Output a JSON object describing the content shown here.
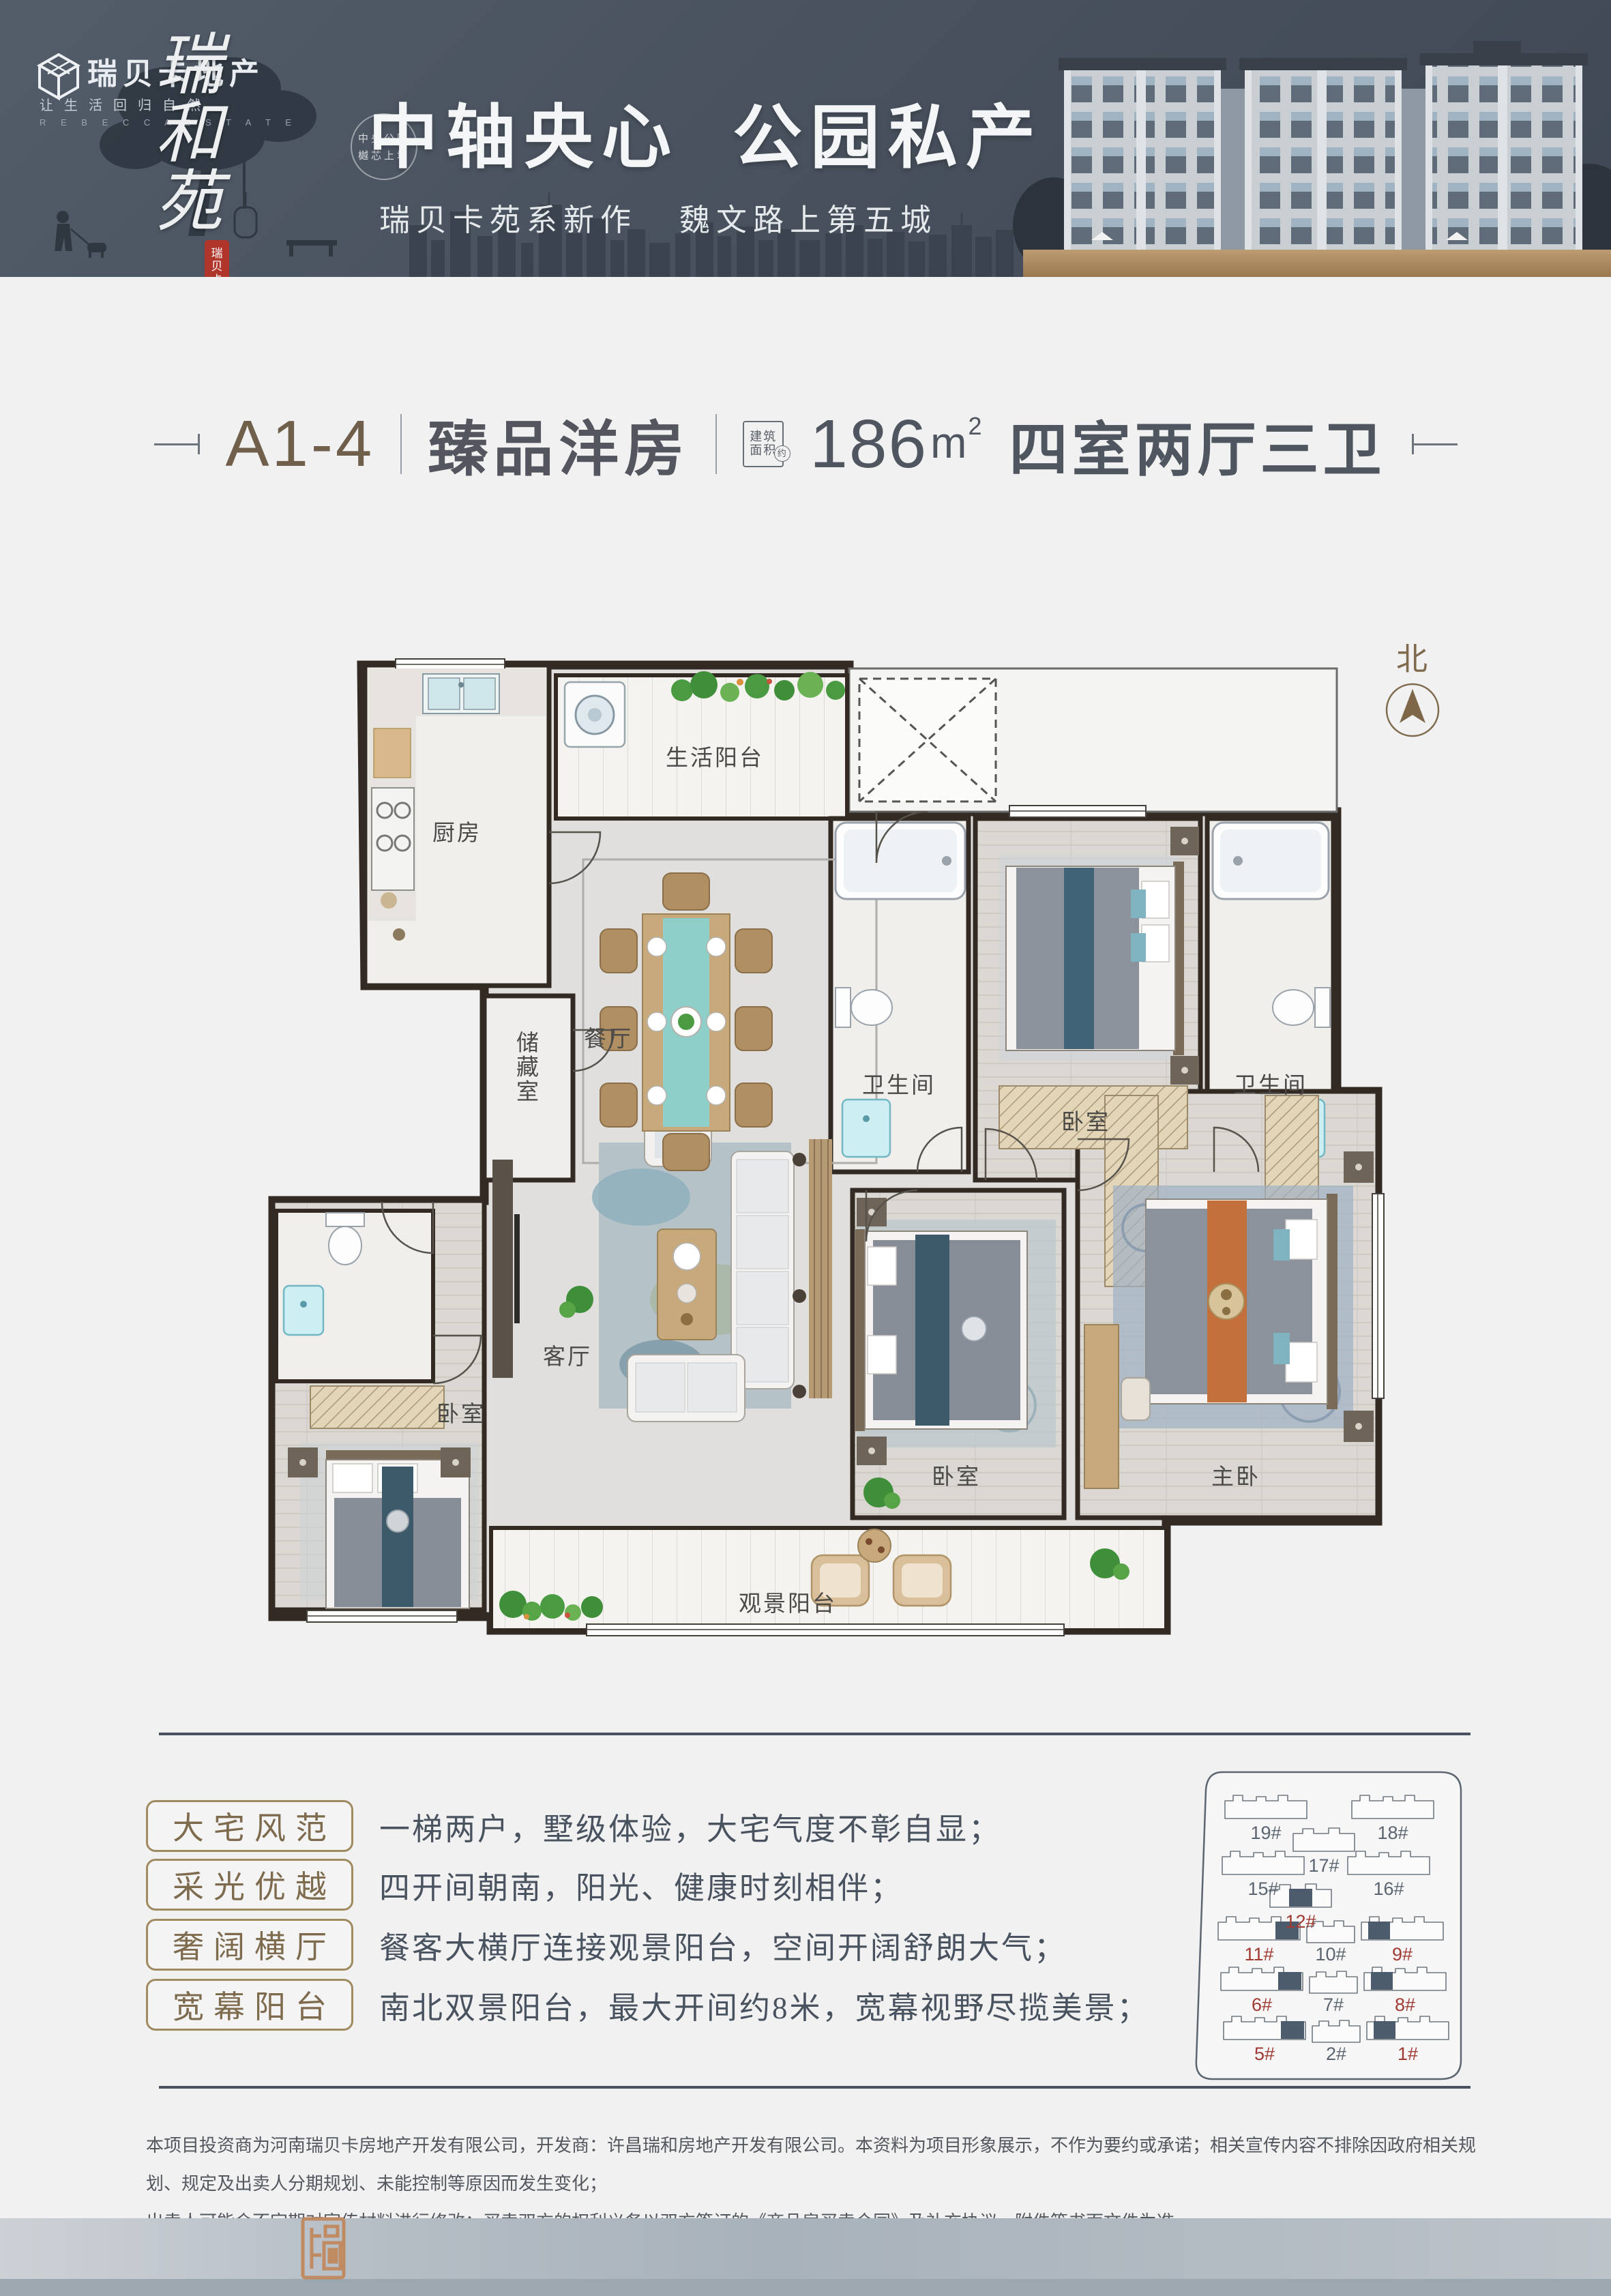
{
  "banner": {
    "logo_name": "瑞贝卡地产",
    "logo_tagline": "让生活回归自然",
    "logo_sub": "R E B E C C A E S T A T E",
    "brand_vertical": "瑞和苑",
    "seal_vertical": "瑞贝卡",
    "badge_line1": "中央公园",
    "badge_line2": "樾芯上境",
    "title_part1": "中轴央心",
    "title_part2": "公园私产",
    "subtitle_left": "瑞贝卡苑系新作",
    "subtitle_right": "魏文路上第五城",
    "accent_gold": "#b6956d"
  },
  "header": {
    "unit_code": "A1-4",
    "product_type": "臻品洋房",
    "area_box_line1": "建筑",
    "area_box_line2": "面积",
    "area_box_circle": "约",
    "area_value": "186",
    "area_unit": "m",
    "area_unit_sup": "2",
    "layout_desc": "四室两厅三卫",
    "accent_color": "#6f5f4b"
  },
  "plan": {
    "north_label": "北",
    "rooms": {
      "kitchen": "厨房",
      "north_balcony": "生活阳台",
      "dining": "餐厅",
      "storage": "储藏室",
      "bath_a": "卫生间",
      "north_bedroom": "卧室",
      "bath_b": "卫生间",
      "living": "客厅",
      "west_bedroom": "卧室",
      "center_bedroom": "卧室",
      "master_bedroom": "主卧",
      "south_balcony": "观景阳台"
    }
  },
  "features": [
    {
      "label": "大宅风范",
      "desc": "一梯两户，墅级体验，大宅气度不彰自显；"
    },
    {
      "label": "采光优越",
      "desc": "四开间朝南，阳光、健康时刻相伴；"
    },
    {
      "label": "奢阔横厅",
      "desc": "餐客大横厅连接观景阳台，空间开阔舒朗大气；"
    },
    {
      "label": "宽幕阳台",
      "desc": "南北双景阳台，最大开间约8米，宽幕视野尽揽美景；"
    }
  ],
  "sitemap": {
    "buildings": [
      {
        "label": "19#",
        "highlight": false
      },
      {
        "label": "18#",
        "highlight": false
      },
      {
        "label": "17#",
        "highlight": false
      },
      {
        "label": "15#",
        "highlight": false
      },
      {
        "label": "16#",
        "highlight": false
      },
      {
        "label": "12#",
        "highlight": true
      },
      {
        "label": "11#",
        "highlight": true
      },
      {
        "label": "10#",
        "highlight": false
      },
      {
        "label": "9#",
        "highlight": true
      },
      {
        "label": "6#",
        "highlight": true
      },
      {
        "label": "7#",
        "highlight": false
      },
      {
        "label": "8#",
        "highlight": true
      },
      {
        "label": "5#",
        "highlight": true
      },
      {
        "label": "2#",
        "highlight": false
      },
      {
        "label": "1#",
        "highlight": true
      }
    ],
    "highlight_color": "#4d5c6d",
    "red_label_color": "#a03a32"
  },
  "disclaimer": {
    "line1": "本项目投资商为河南瑞贝卡房地产开发有限公司，开发商：许昌瑞和房地产开发有限公司。本资料为项目形象展示，不作为要约或承诺；相关宣传内容不排除因政府相关规划、规定及出卖人分期规划、未能控制等原因而发生变化；",
    "line2": "出卖人可能会不定期对宣传材料进行修改；买卖双方的权利义务以双方签订的《商品房买卖合同》及补充协议、附件等书面文件为准。"
  }
}
